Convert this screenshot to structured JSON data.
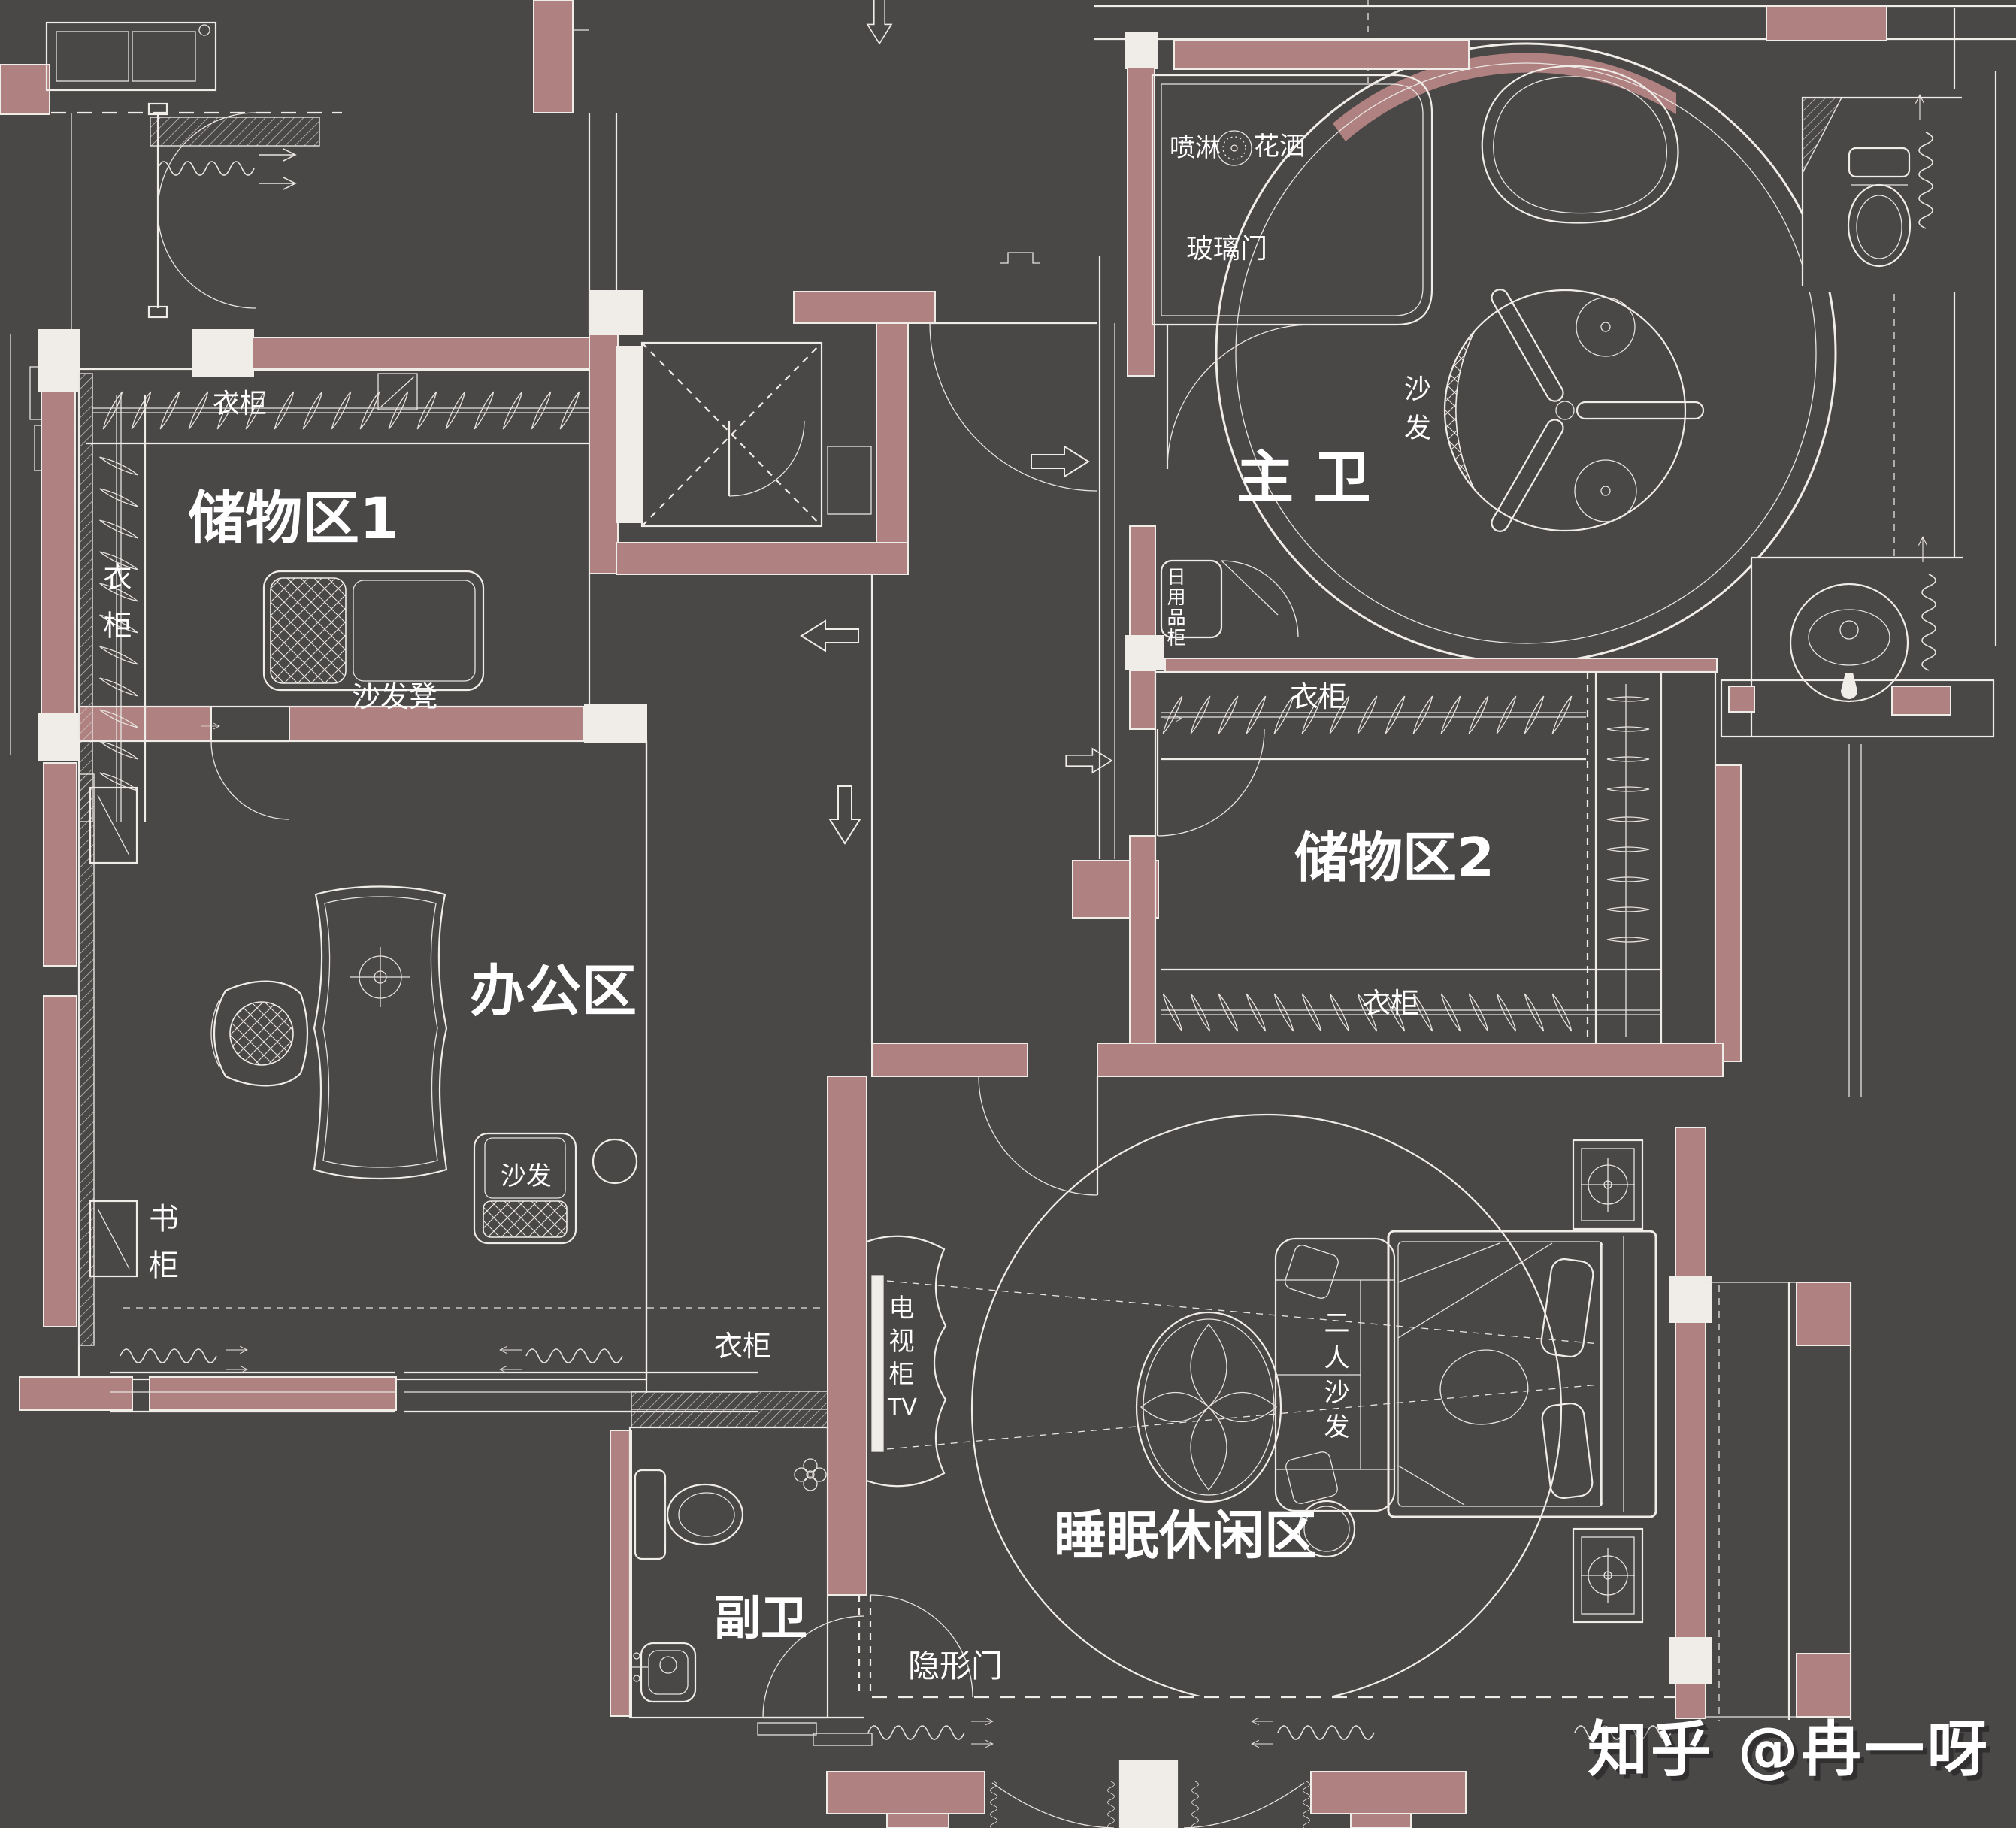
{
  "colors": {
    "background": "#4a4747",
    "wall_fill": "#b08181",
    "line": "#f0ede9",
    "text": "#ffffff"
  },
  "rooms": {
    "storage1": {
      "label": "储物区1"
    },
    "master_bath": {
      "label": "主 卫"
    },
    "office": {
      "label": "办公区"
    },
    "storage2": {
      "label": "储物区2"
    },
    "sleep_leisure": {
      "label": "睡眠休闲区"
    },
    "sub_bath": {
      "label": "副卫"
    }
  },
  "annotations": {
    "wardrobe_s1_top": "衣柜",
    "wardrobe_s1_left": "衣柜",
    "sofa_stool": "沙发凳",
    "shower_spray": "喷淋",
    "shower_head": "花洒",
    "glass_door": "玻璃门",
    "bath_sofa": "沙发",
    "daily_goods_cabinet": "日用品柜",
    "bookcase": "书柜",
    "office_sofa": "沙发",
    "wardrobe_s2_top": "衣柜",
    "wardrobe_s2_bottom": "衣柜",
    "wardrobe_corridor": "衣柜",
    "tv_cabinet": "电视柜",
    "tv": "TV",
    "two_seat_sofa": "二人沙发",
    "hidden_door": "隐形门"
  },
  "watermark": "知乎 @冉一呀"
}
